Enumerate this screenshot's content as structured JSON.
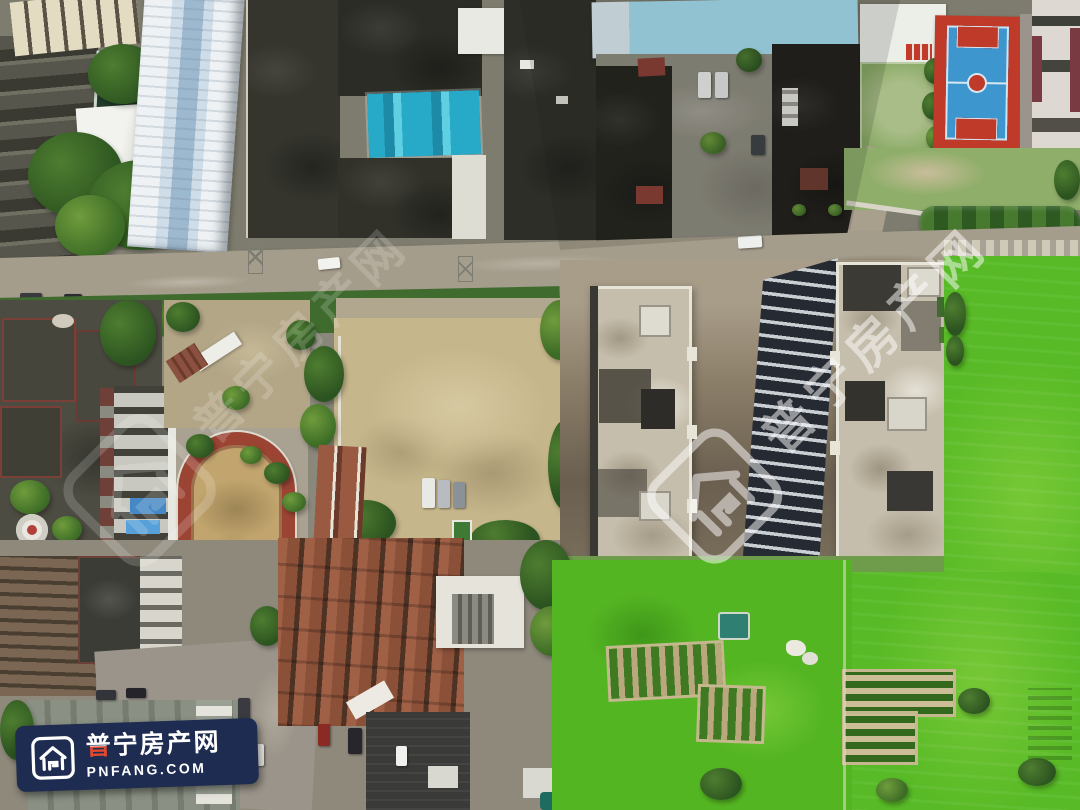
{
  "brand": {
    "name": "普宁房产网",
    "name_first_char": "普",
    "name_rest": "宁房产网",
    "url": "PNFANG.COM",
    "logo_icon": "house-logo-icon",
    "banner_bg": "#1d2c50",
    "text_color": "#ffffff",
    "accent_red": "#e2492f"
  },
  "watermark": {
    "text": "普宁房产网",
    "color": "#ffffff",
    "center_opacity": 0.5,
    "left_opacity": 0.17
  },
  "scene": {
    "type": "aerial-drone-photo",
    "landmarks": [
      "warehouse-white-blue-roof",
      "dark-factory-roofs",
      "blue-tarp-roof",
      "cyan-metal-roof",
      "courtyard-with-cars",
      "basketball-court",
      "grass-yard",
      "school-building",
      "running-track",
      "muddy-vacant-lot",
      "parked-trucks",
      "construction-tower-left",
      "construction-tower-right",
      "glass-facade-tower",
      "main-road",
      "hedge-row",
      "green-farm-field",
      "vegetable-garden-plots",
      "village-tile-roofs",
      "street-intersection",
      "pond"
    ],
    "palette": {
      "field_green": "#58ba26",
      "garden_green": "#3f9a18",
      "tree_green": "#2c5420",
      "mud_tan": "#c6b68b",
      "road_grey": "#a59d8b",
      "roof_dark": "#2e2e28",
      "tile_rust": "#9a5f46",
      "track_red": "#9c4434",
      "infield_tan": "#c2a56e",
      "court_blue": "#3e96ce",
      "court_red": "#bf3a28",
      "cyan_roof": "#a6e0f2",
      "warehouse_blue": "#9db9cf",
      "tarp_teal": "#27a9c8",
      "tower_concrete": "#c6beac",
      "facade_dark": "#262b33",
      "facade_light": "#c9ced3",
      "school_blue": "#4688c4"
    }
  }
}
